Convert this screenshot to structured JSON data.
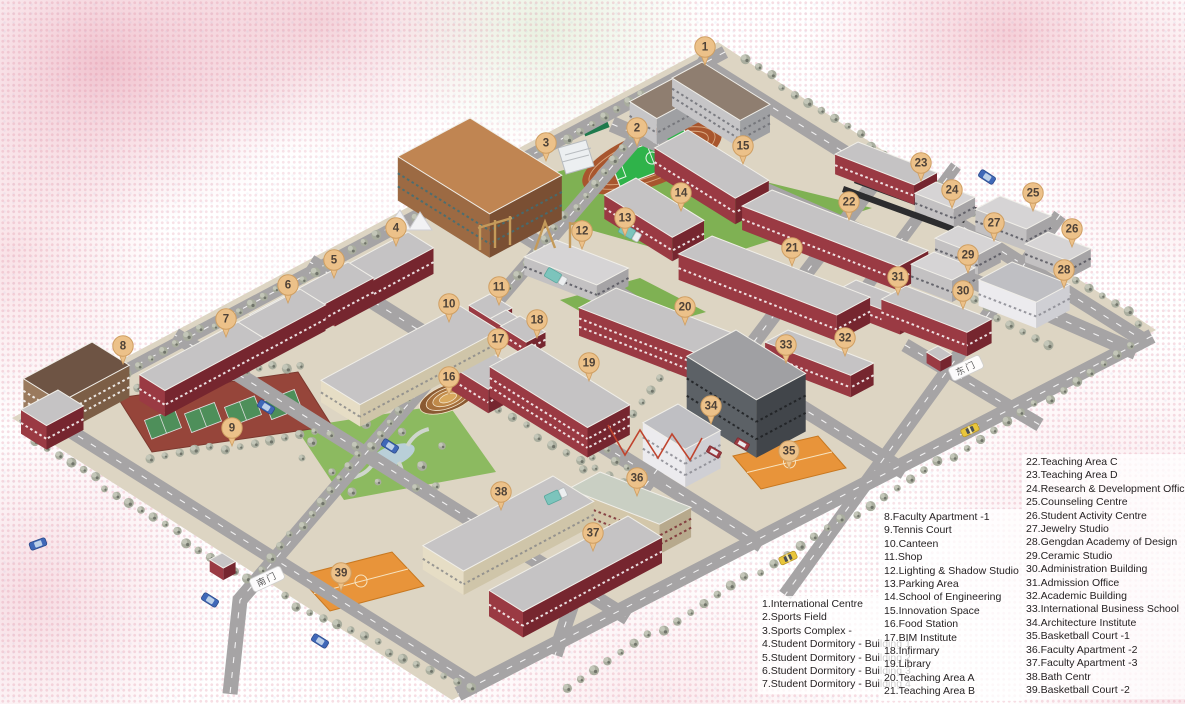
{
  "legend": {
    "block1": {
      "items": [
        "1.International Centre",
        "2.Sports Field",
        "3.Sports Complex -",
        "4.Student Dormitory - Building 1",
        "5.Student Dormitory - Building 2",
        "6.Student Dormitory - Building 3",
        "7.Student Dormitory - Building 4"
      ]
    },
    "block2": {
      "items": [
        "8.Faculty Apartment -1",
        "9.Tennis Court",
        "10.Canteen",
        "11.Shop",
        "12.Lighting & Shadow Studio",
        "13.Parking Area",
        "14.School of Engineering",
        "15.Innovation Space",
        "16.Food Station",
        "17.BIM Institute",
        "18.Infirmary",
        "19.Library",
        "20.Teaching Area A",
        "21.Teaching Area B"
      ]
    },
    "block3": {
      "items": [
        "22.Teaching Area C",
        "23.Teaching Area D",
        "24.Research & Development Office",
        "25.Counseling Centre",
        "26.Student Activity Centre",
        "27.Jewelry Studio",
        "28.Gengdan Academy of Design",
        "29.Ceramic Studio",
        "30.Administration Building",
        "31.Admission Office",
        "32.Academic Building",
        "33.International Business School",
        "34.Architecture Institute",
        "35.Basketball Court -1",
        "36.Faculty Apartment -2",
        "37.Faculty Apartment -3",
        "38.Bath Centr",
        "39.Basketball Court -2"
      ]
    }
  },
  "map": {
    "pins": [
      {
        "n": 1,
        "x": 705,
        "y": 47
      },
      {
        "n": 2,
        "x": 637,
        "y": 128
      },
      {
        "n": 3,
        "x": 546,
        "y": 143
      },
      {
        "n": 4,
        "x": 396,
        "y": 228
      },
      {
        "n": 5,
        "x": 334,
        "y": 260
      },
      {
        "n": 6,
        "x": 288,
        "y": 285
      },
      {
        "n": 7,
        "x": 226,
        "y": 319
      },
      {
        "n": 8,
        "x": 123,
        "y": 346
      },
      {
        "n": 9,
        "x": 232,
        "y": 428
      },
      {
        "n": 10,
        "x": 449,
        "y": 304
      },
      {
        "n": 11,
        "x": 499,
        "y": 287
      },
      {
        "n": 12,
        "x": 582,
        "y": 231
      },
      {
        "n": 13,
        "x": 625,
        "y": 218
      },
      {
        "n": 14,
        "x": 681,
        "y": 193
      },
      {
        "n": 15,
        "x": 743,
        "y": 146
      },
      {
        "n": 16,
        "x": 449,
        "y": 377
      },
      {
        "n": 17,
        "x": 498,
        "y": 339
      },
      {
        "n": 18,
        "x": 537,
        "y": 320
      },
      {
        "n": 19,
        "x": 589,
        "y": 363
      },
      {
        "n": 20,
        "x": 685,
        "y": 307
      },
      {
        "n": 21,
        "x": 792,
        "y": 248
      },
      {
        "n": 22,
        "x": 849,
        "y": 202
      },
      {
        "n": 23,
        "x": 921,
        "y": 163
      },
      {
        "n": 24,
        "x": 952,
        "y": 190
      },
      {
        "n": 25,
        "x": 1033,
        "y": 193
      },
      {
        "n": 26,
        "x": 1072,
        "y": 229
      },
      {
        "n": 27,
        "x": 994,
        "y": 223
      },
      {
        "n": 28,
        "x": 1064,
        "y": 270
      },
      {
        "n": 29,
        "x": 968,
        "y": 255
      },
      {
        "n": 30,
        "x": 963,
        "y": 291
      },
      {
        "n": 31,
        "x": 898,
        "y": 277
      },
      {
        "n": 32,
        "x": 845,
        "y": 338
      },
      {
        "n": 33,
        "x": 786,
        "y": 345
      },
      {
        "n": 34,
        "x": 711,
        "y": 406
      },
      {
        "n": 35,
        "x": 789,
        "y": 451
      },
      {
        "n": 36,
        "x": 637,
        "y": 478
      },
      {
        "n": 37,
        "x": 593,
        "y": 533
      },
      {
        "n": 38,
        "x": 501,
        "y": 492
      },
      {
        "n": 39,
        "x": 341,
        "y": 573
      }
    ],
    "gates": [
      {
        "label": "南门",
        "x": 267,
        "y": 579,
        "angle": -25
      },
      {
        "label": "东门",
        "x": 966,
        "y": 368,
        "angle": -25
      }
    ],
    "vehicles": [
      {
        "type": "truck",
        "x": 630,
        "y": 233,
        "angle": 30
      },
      {
        "type": "truck",
        "x": 556,
        "y": 277,
        "angle": 30
      },
      {
        "type": "truck",
        "x": 556,
        "y": 496,
        "angle": -25
      },
      {
        "type": "car",
        "x": 987,
        "y": 177,
        "angle": 33
      },
      {
        "type": "car",
        "x": 266,
        "y": 407,
        "angle": 32
      },
      {
        "type": "car",
        "x": 390,
        "y": 446,
        "angle": 32
      },
      {
        "type": "car",
        "x": 210,
        "y": 600,
        "angle": 32
      },
      {
        "type": "car",
        "x": 38,
        "y": 544,
        "angle": -20
      },
      {
        "type": "car",
        "x": 320,
        "y": 641,
        "angle": 32
      },
      {
        "type": "taxi",
        "x": 970,
        "y": 430,
        "angle": -25
      },
      {
        "type": "taxi",
        "x": 788,
        "y": 558,
        "angle": -25
      },
      {
        "type": "van",
        "x": 742,
        "y": 444,
        "angle": 30
      },
      {
        "type": "van",
        "x": 714,
        "y": 452,
        "angle": 30
      }
    ],
    "buildings": [
      {
        "id": "international-centre-a",
        "x": 702,
        "y": 62,
        "w": 80,
        "d": 34,
        "h": 28,
        "pal": "intl"
      },
      {
        "id": "international-centre-b",
        "x": 700,
        "y": 64,
        "w": 32,
        "d": 80,
        "h": 26,
        "pal": "intl"
      },
      {
        "id": "sports-complex",
        "x": 470,
        "y": 118,
        "w": 108,
        "d": 82,
        "h": 44,
        "pal": "complex"
      },
      {
        "id": "student-dormitory-1",
        "x": 408,
        "y": 232,
        "w": 30,
        "d": 112,
        "h": 26,
        "pal": "maroon"
      },
      {
        "id": "student-dormitory-2",
        "x": 348,
        "y": 262,
        "w": 30,
        "d": 112,
        "h": 26,
        "pal": "maroon"
      },
      {
        "id": "student-dormitory-3",
        "x": 300,
        "y": 289,
        "w": 30,
        "d": 112,
        "h": 26,
        "pal": "maroon"
      },
      {
        "id": "student-dormitory-4",
        "x": 238,
        "y": 322,
        "w": 30,
        "d": 112,
        "h": 26,
        "pal": "maroon"
      },
      {
        "id": "faculty-apartment-1",
        "x": 92,
        "y": 342,
        "w": 44,
        "d": 78,
        "h": 32,
        "pal": "brown"
      },
      {
        "id": "faculty-apartment-1-wing",
        "x": 58,
        "y": 390,
        "w": 30,
        "d": 42,
        "h": 24,
        "pal": "maroon"
      },
      {
        "id": "canteen",
        "x": 460,
        "y": 306,
        "w": 46,
        "d": 158,
        "h": 22,
        "pal": "cream"
      },
      {
        "id": "shop",
        "x": 490,
        "y": 294,
        "w": 26,
        "d": 24,
        "h": 15,
        "pal": "maroon"
      },
      {
        "id": "shop-annex",
        "x": 506,
        "y": 310,
        "w": 20,
        "d": 18,
        "h": 12,
        "pal": "maroon"
      },
      {
        "id": "lighting-shadow-studio",
        "x": 556,
        "y": 240,
        "w": 78,
        "d": 36,
        "h": 18,
        "pal": "grey",
        "sa": true
      },
      {
        "id": "school-of-engineering",
        "x": 636,
        "y": 178,
        "w": 80,
        "d": 36,
        "h": 24,
        "pal": "maroon"
      },
      {
        "id": "innovation-space",
        "x": 688,
        "y": 130,
        "w": 95,
        "d": 38,
        "h": 26,
        "pal": "maroon"
      },
      {
        "id": "bim-institute",
        "x": 452,
        "y": 328,
        "w": 82,
        "d": 38,
        "h": 24,
        "pal": "maroon"
      },
      {
        "id": "infirmary",
        "x": 520,
        "y": 316,
        "w": 30,
        "d": 22,
        "h": 14,
        "pal": "maroon"
      },
      {
        "id": "library",
        "x": 532,
        "y": 344,
        "w": 115,
        "d": 48,
        "h": 30,
        "pal": "maroon"
      },
      {
        "id": "teaching-area-a",
        "x": 616,
        "y": 288,
        "w": 150,
        "d": 42,
        "h": 28,
        "pal": "maroon",
        "sa": true
      },
      {
        "id": "teaching-area-b",
        "x": 712,
        "y": 236,
        "w": 170,
        "d": 38,
        "h": 26,
        "pal": "maroon",
        "sa": true
      },
      {
        "id": "teaching-area-c",
        "x": 772,
        "y": 190,
        "w": 168,
        "d": 34,
        "h": 24,
        "pal": "maroon",
        "sa": true
      },
      {
        "id": "teaching-area-d",
        "x": 858,
        "y": 142,
        "w": 85,
        "d": 26,
        "h": 20,
        "pal": "maroon",
        "sa": true
      },
      {
        "id": "research-development-office",
        "x": 936,
        "y": 182,
        "w": 42,
        "d": 24,
        "h": 18,
        "pal": "grey",
        "sa": true
      },
      {
        "id": "counseling-centre",
        "x": 1000,
        "y": 196,
        "w": 55,
        "d": 28,
        "h": 22,
        "pal": "grey",
        "sa": true
      },
      {
        "id": "student-activity-centre",
        "x": 1048,
        "y": 232,
        "w": 46,
        "d": 26,
        "h": 18,
        "pal": "grey",
        "sa": true
      },
      {
        "id": "jewelry-studio",
        "x": 958,
        "y": 226,
        "w": 46,
        "d": 26,
        "h": 20,
        "pal": "grey",
        "sa": true
      },
      {
        "id": "gengdan-academy-of-design",
        "x": 1012,
        "y": 262,
        "w": 62,
        "d": 38,
        "h": 26,
        "pal": "white",
        "sa": true
      },
      {
        "id": "ceramic-studio",
        "x": 934,
        "y": 252,
        "w": 44,
        "d": 26,
        "h": 22,
        "pal": "grey",
        "sa": true
      },
      {
        "id": "administration-building",
        "x": 906,
        "y": 286,
        "w": 92,
        "d": 28,
        "h": 24,
        "pal": "maroon",
        "sa": true
      },
      {
        "id": "admission-office",
        "x": 856,
        "y": 280,
        "w": 70,
        "d": 24,
        "h": 18,
        "pal": "maroon",
        "sa": true
      },
      {
        "id": "academic-building",
        "x": 788,
        "y": 330,
        "w": 92,
        "d": 26,
        "h": 22,
        "pal": "maroon",
        "sa": true
      },
      {
        "id": "international-business-school",
        "x": 736,
        "y": 330,
        "w": 82,
        "d": 56,
        "h": 58,
        "pal": "dark"
      },
      {
        "id": "ibs-tower",
        "x": 716,
        "y": 342,
        "w": 16,
        "d": 16,
        "h": 66,
        "pal": "white"
      },
      {
        "id": "architecture-institute",
        "x": 678,
        "y": 404,
        "w": 50,
        "d": 40,
        "h": 38,
        "pal": "white"
      },
      {
        "id": "faculty-apartment-2",
        "x": 600,
        "y": 472,
        "w": 98,
        "d": 36,
        "h": 30,
        "pal": "tan",
        "sa": true
      },
      {
        "id": "faculty-apartment-3",
        "x": 628,
        "y": 516,
        "w": 40,
        "d": 158,
        "h": 26,
        "pal": "maroon"
      },
      {
        "id": "bath-centre",
        "x": 553,
        "y": 476,
        "w": 48,
        "d": 148,
        "h": 24,
        "pal": "cream"
      },
      {
        "id": "guard-house-south",
        "x": 222,
        "y": 553,
        "w": 16,
        "d": 14,
        "h": 12,
        "pal": "maroon"
      },
      {
        "id": "guard-house-east",
        "x": 938,
        "y": 346,
        "w": 16,
        "d": 13,
        "h": 11,
        "pal": "maroon"
      }
    ],
    "colors": {
      "pin": "#ecc189",
      "pinBorder": "#cf9f63",
      "pinText": "#4e4238",
      "road": "#a6a4a5",
      "roadDash": "#ffffff",
      "ground": "#ddd5c3",
      "lawn": "#7fb153",
      "parkLawn": "#8cba60",
      "track": "#a8562e",
      "pitch": "#2fb34a",
      "courtOrange": "#e8943a",
      "tennisBase": "#96453a",
      "tennisCourt": "#4e8f5a",
      "pond": "#b9cfd8",
      "tree": "#a9ad9e",
      "treeLight": "#c3c6b8",
      "treeDark": "#70746a",
      "panel": "#2c2c2e",
      "lattice": "#c0442e",
      "frame": "#c49a5a",
      "palettes": {
        "maroon": {
          "roof": "#c5c3c4",
          "wl": "#9a3a43",
          "wr": "#76262f",
          "win": "#ffffff"
        },
        "grey": {
          "roof": "#d6d4d5",
          "wl": "#c3c1c2",
          "wr": "#a6a4a6",
          "win": "#55555e"
        },
        "white": {
          "roof": "#bfbfc3",
          "wl": "#ecebee",
          "wr": "#cfcfd4",
          "win": "#8a8a92"
        },
        "dark": {
          "roof": "#a0a0a3",
          "wl": "#5c6166",
          "wr": "#41454a",
          "win": "#1e2023"
        },
        "tan": {
          "roof": "#c9cfc3",
          "wl": "#d3c7aa",
          "wr": "#b7a98c",
          "win": "#7a2d33"
        },
        "brown": {
          "roof": "#6e5444",
          "wl": "#9a7a5e",
          "wr": "#7c5e46",
          "win": "#ffffff"
        },
        "cream": {
          "roof": "#c6c4c5",
          "wl": "#e6ddc5",
          "wr": "#cfc5a9",
          "win": "#8a8a8a"
        },
        "complex": {
          "roof": "#c08552",
          "wl": "#9c6a43",
          "wr": "#7a4f33",
          "win": "#3f6f78"
        },
        "intl": {
          "roof": "#8f7e70",
          "wl": "#c6c5c7",
          "wr": "#9fa0a3",
          "win": "#6f7076"
        }
      }
    }
  }
}
